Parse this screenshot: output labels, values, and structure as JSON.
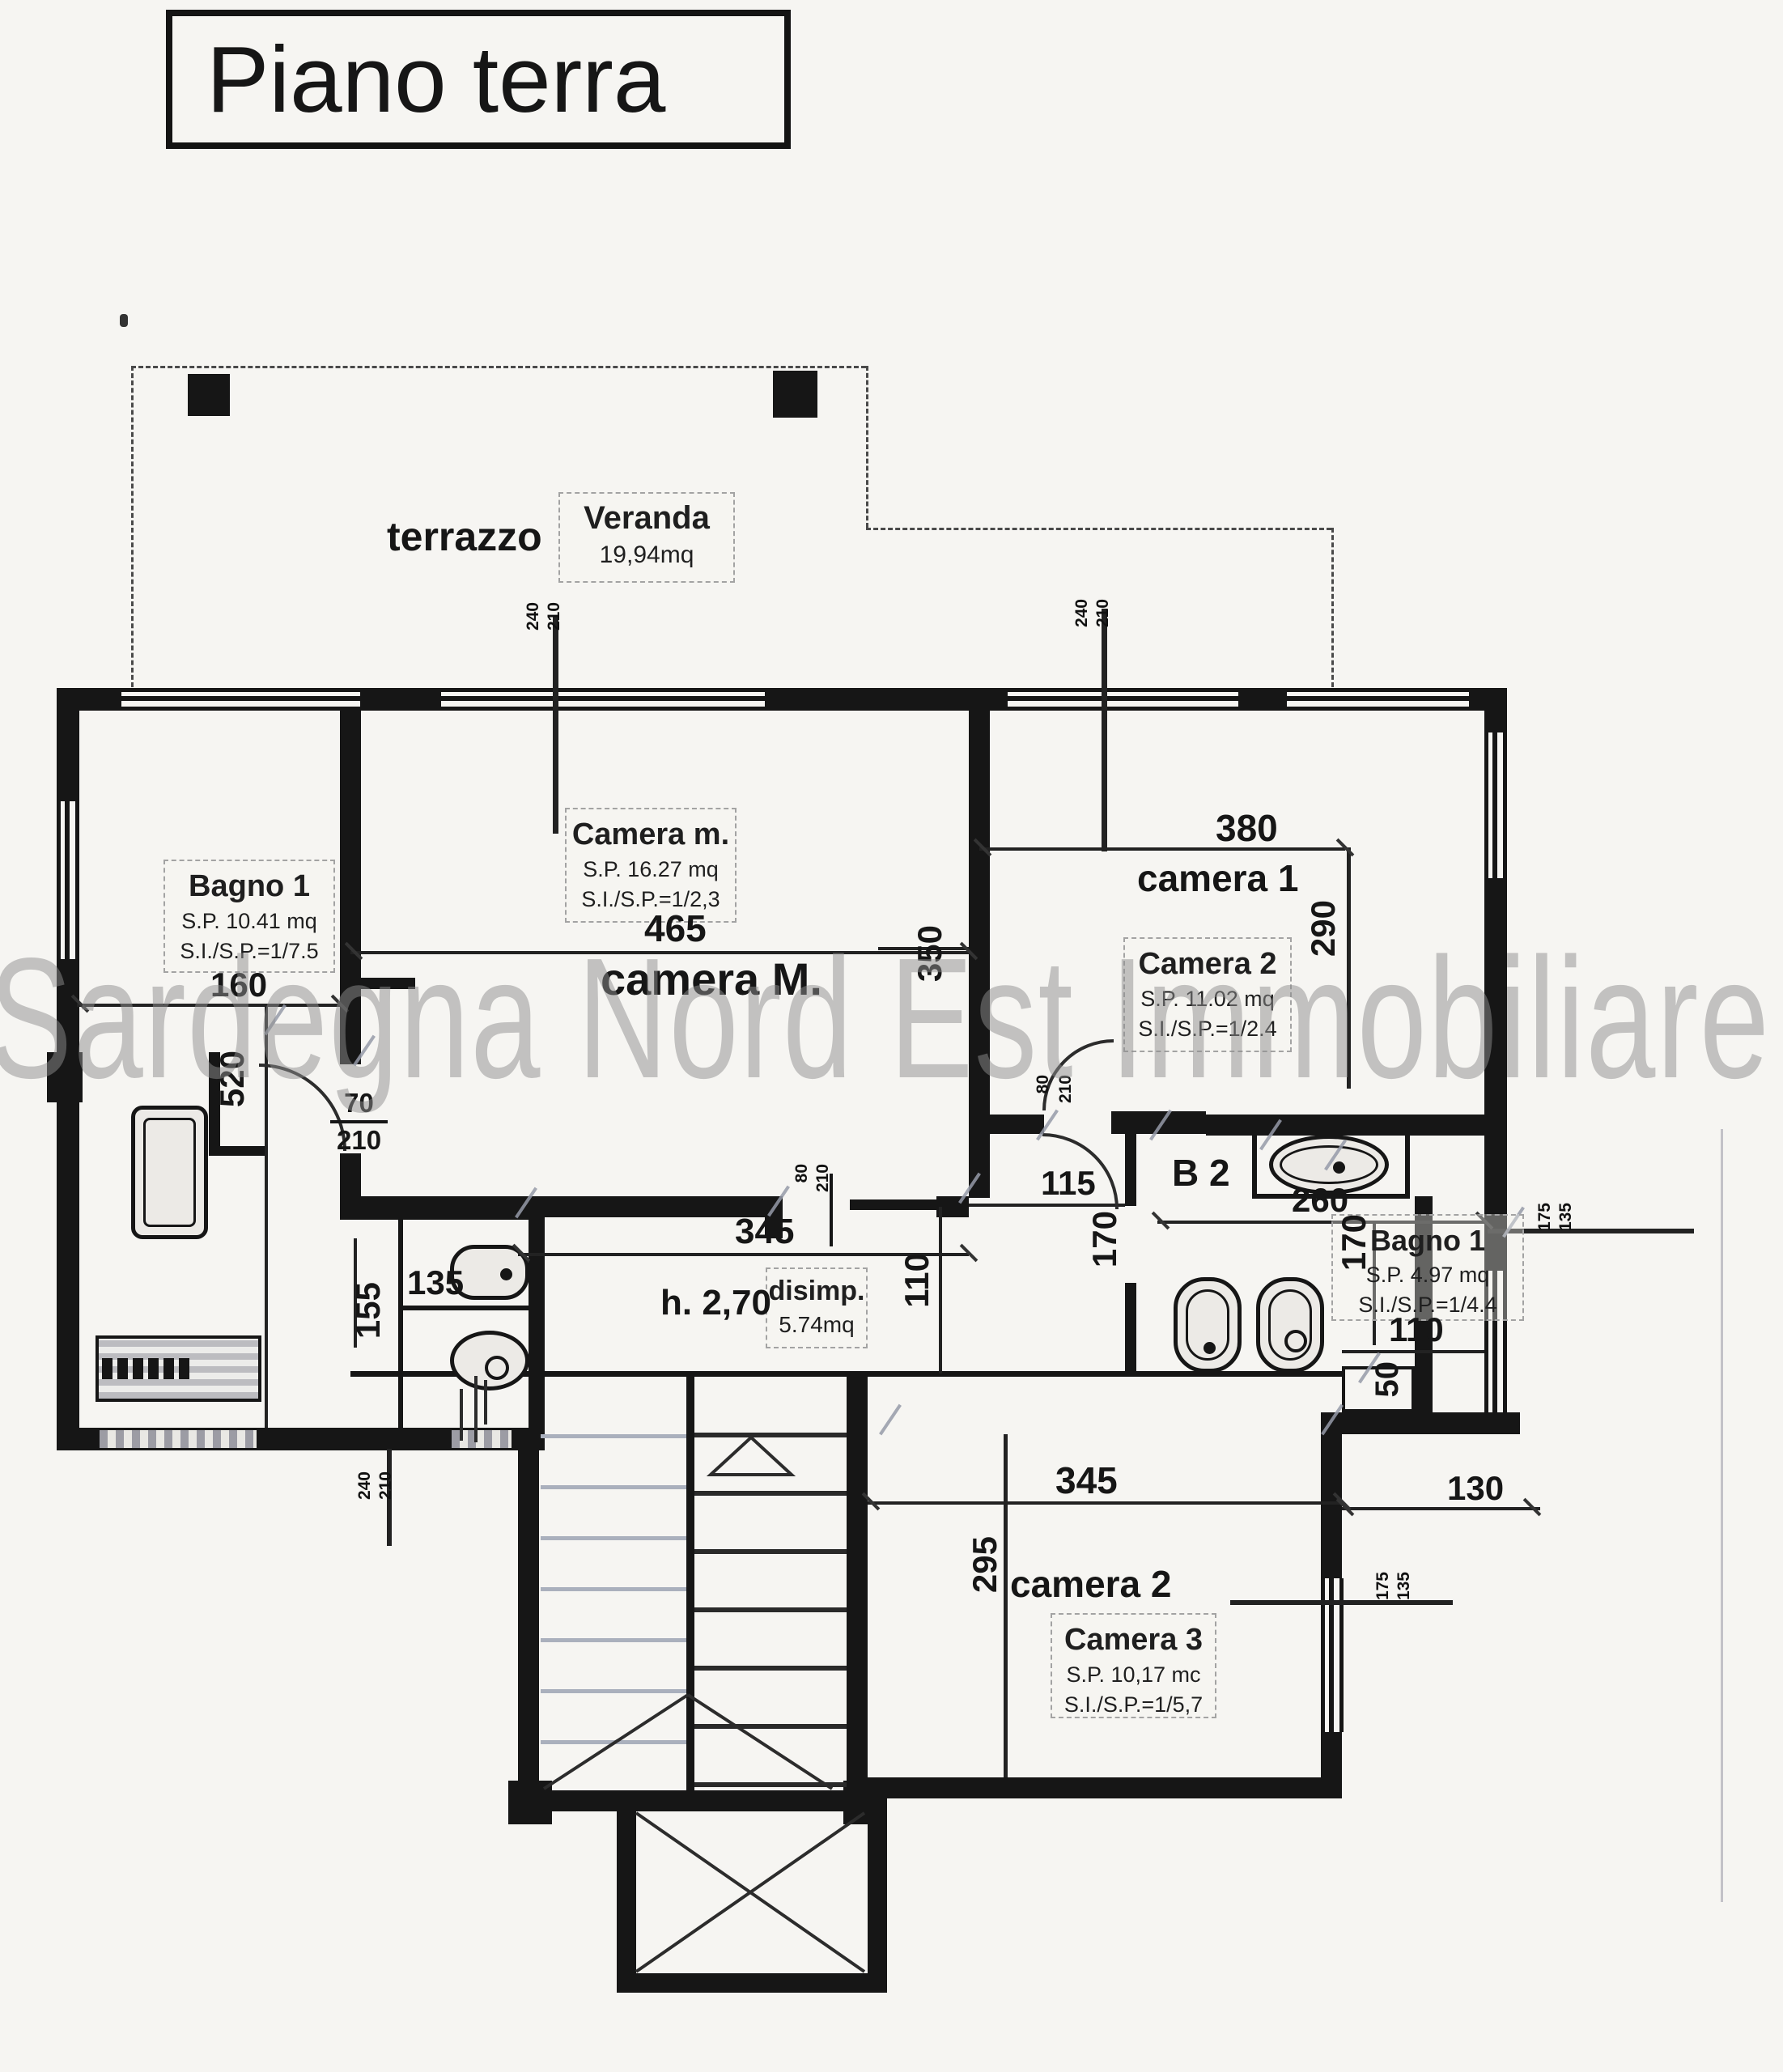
{
  "title": "Piano terra",
  "watermark": "Sardegna Nord Est Immobiliare",
  "terrace": {
    "label": "terrazzo"
  },
  "veranda": {
    "name": "Veranda",
    "area": "19,94mq"
  },
  "rooms": {
    "bagno1_left": {
      "name": "Bagno 1",
      "sp": "S.P. 10.41 mq",
      "ratio": "S.I./S.P.=1/7.5"
    },
    "camera_m": {
      "name": "Camera m.",
      "sp": "S.P. 16.27 mq",
      "ratio": "S.I./S.P.=1/2,3"
    },
    "camera_m_floor_label": "camera M.",
    "camera1_floor_label": "camera 1",
    "camera2": {
      "name": "Camera 2",
      "sp": "S.P. 11.02 mq",
      "ratio": "S.I./S.P.=1/2.4"
    },
    "disimp": {
      "name": "disimp.",
      "area": "5.74mq"
    },
    "height_note": "h. 2,70",
    "b2_label": "B 2",
    "bagno1_right": {
      "name": "Bagno 1",
      "sp": "S.P. 4.97 mq",
      "ratio": "S.I./S.P.=1/4.4"
    },
    "camera2_floor_label": "camera 2",
    "camera3": {
      "name": "Camera 3",
      "sp": "S.P. 10,17 mc",
      "ratio": "S.I./S.P.=1/5,7"
    }
  },
  "dimensions": {
    "bagno1_width": "160",
    "bagno1_height": "520",
    "cameraM_width": "465",
    "cameraM_height": "350",
    "camera1_width": "380",
    "camera1_height": "290",
    "door1_w": "70",
    "door1_h": "210",
    "door2_w": "80",
    "door2_h": "210",
    "door3_w": "80",
    "door3_h": "210",
    "corridor_length": "345",
    "corridor_width": "110",
    "opening_115": "115",
    "b2_width": "170",
    "alcove_260": "260",
    "bagnoR_height": "170",
    "bagnoR_width": "110",
    "bagnoR_50": "50",
    "nook_width": "135",
    "nook_155": "155",
    "camera3_width": "345",
    "camera3_height": "295",
    "offset_130": "130"
  },
  "window_markers": {
    "m1a": "240",
    "m1b": "210",
    "m2a": "240",
    "m2b": "210",
    "m3a": "240",
    "m3b": "210",
    "m4a": "175",
    "m4b": "135",
    "m5a": "175",
    "m5b": "135"
  },
  "colors": {
    "ink": "#1a1a1a",
    "paper": "#f6f5f2",
    "watermark": "#8f8f8f",
    "pencil": "#9298a6"
  }
}
